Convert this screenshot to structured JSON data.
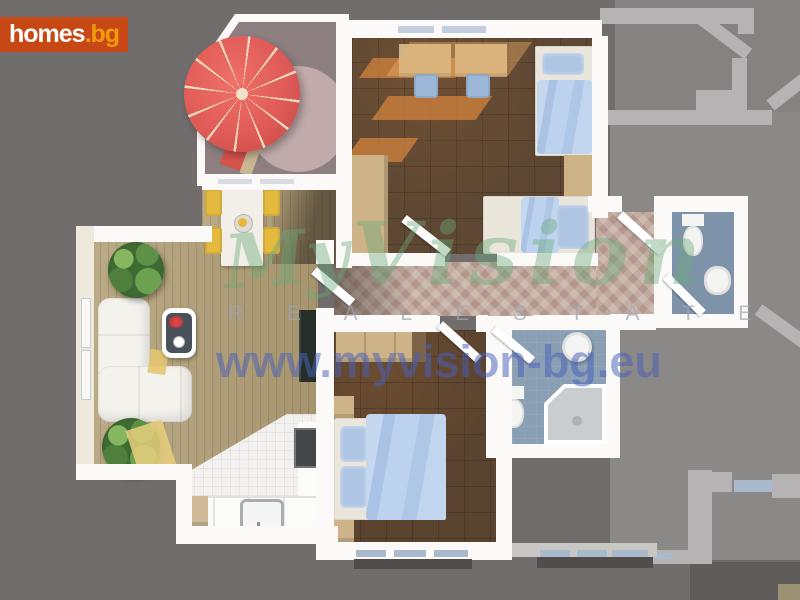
{
  "logo": {
    "main": "homes",
    "suffix": ".bg"
  },
  "watermark": {
    "script_word_1": "My",
    "script_word_2": "Vision",
    "tagline": "R E A L   E S T A T E",
    "url": "www.myvision-bg.eu"
  },
  "floorplan": {
    "view": "3d-top-down-apartment-floor-plan",
    "rooms": [
      "terrace",
      "living-room",
      "dining-area",
      "kitchen",
      "children-bedroom",
      "master-bedroom",
      "hallway",
      "entrance-hall",
      "bathroom",
      "wc"
    ],
    "furniture": [
      "parasol",
      "sun-lounger",
      "dining-table",
      "dining-chairs",
      "corner-sofa",
      "coffee-table",
      "potted-plants",
      "tv",
      "kitchen-counter",
      "kitchen-sink",
      "stove",
      "desks",
      "desk-chairs",
      "single-beds",
      "double-bed",
      "wardrobes",
      "dresser",
      "nightstands",
      "toilets",
      "washbasins",
      "corner-shower"
    ],
    "colors": {
      "background": "#716d6d",
      "neighbor_floor": "#8b8888",
      "apartment_walls": "#fbfaf8",
      "living_wood_floor": "#b3a179",
      "bedroom_wood_floor": "#5e4733",
      "hall_tiles": "#c0a99e",
      "kitchen_tiles": "#f2f1ef",
      "bath_floor": "#8a9fb3",
      "bedding_blue": "#b9cfec",
      "parasol_red": "#e05b57",
      "chair_yellow": "#e3b93e",
      "logo_background": "#c84815",
      "logo_suffix_color": "#f0990b",
      "watermark_green": "#6aa97a",
      "watermark_blue": "#4a60bc"
    }
  }
}
